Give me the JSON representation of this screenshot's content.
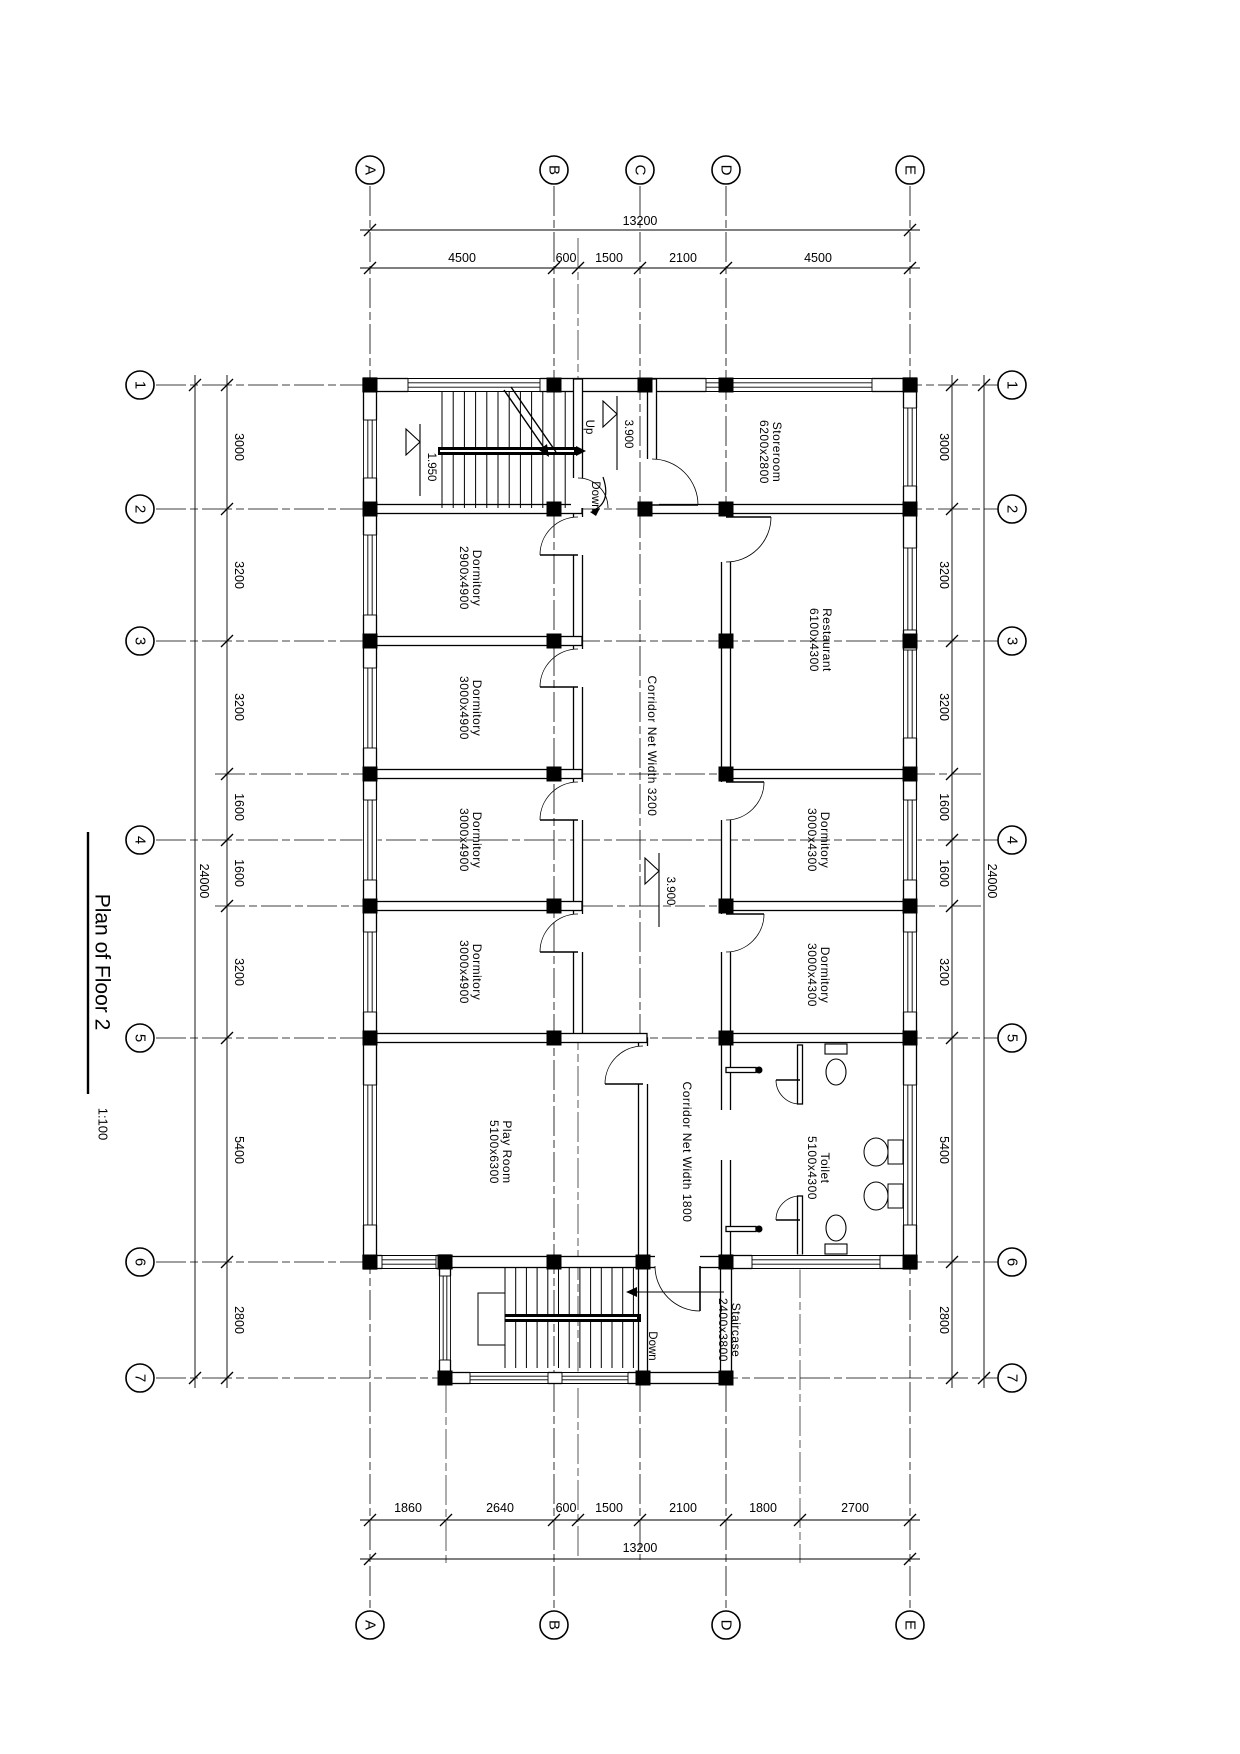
{
  "title": {
    "text": "Plan of Floor 2",
    "scale": "1:100"
  },
  "grid": {
    "cols": [
      "A",
      "B",
      "C",
      "D",
      "E"
    ],
    "rows": [
      "1",
      "2",
      "3",
      "4",
      "5",
      "6",
      "7"
    ]
  },
  "dims": {
    "top_total": "13200",
    "bottom_total": "13200",
    "side_total": "24000",
    "top": [
      "4500",
      "600",
      "1500",
      "2100",
      "4500"
    ],
    "bottom": [
      "1860",
      "2640",
      "600",
      "1500",
      "2100",
      "1800",
      "2700"
    ],
    "side": [
      "3000",
      "3200",
      "3200",
      "1600",
      "1600",
      "3200",
      "5400",
      "2800"
    ]
  },
  "rooms": {
    "storeroom": {
      "name": "Storeroom",
      "size": "6200x2800"
    },
    "dormitory_a": {
      "name": "Dormitory",
      "size": "2900x4900"
    },
    "dormitory_b": {
      "name": "Dormitory",
      "size": "3000x4900"
    },
    "dormitory_c": {
      "name": "Dormitory",
      "size": "3000x4900"
    },
    "dormitory_d": {
      "name": "Dormitory",
      "size": "3000x4900"
    },
    "play_room": {
      "name": "Play Room",
      "size": "5100x6300"
    },
    "restaurant": {
      "name": "Restaurant",
      "size": "6100x4300"
    },
    "dormitory_e": {
      "name": "Dormitory",
      "size": "3000x4300"
    },
    "dormitory_f": {
      "name": "Dormitory",
      "size": "3000x4300"
    },
    "toilet": {
      "name": "Toilet",
      "size": "5100x4300"
    },
    "staircase": {
      "name": "Staircase",
      "size": "2400x3800"
    }
  },
  "corridors": {
    "main": "Corridor Net Width 3200",
    "secondary": "Corridor Net Width 1800"
  },
  "levels": {
    "upper": "3.900",
    "mid": "3.900",
    "half": "1.950"
  },
  "stairs": {
    "up": "Up",
    "down_top": "Down",
    "down_bottom": "Down"
  }
}
